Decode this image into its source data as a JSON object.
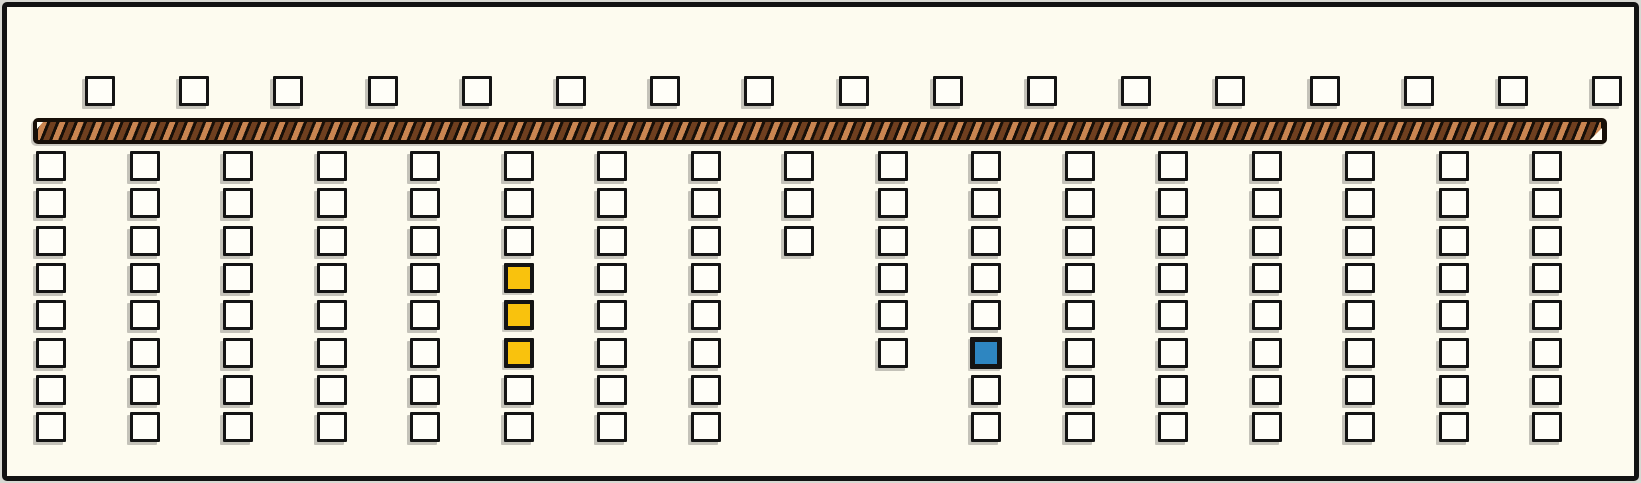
{
  "diagram": {
    "kind": "hatched-track-with-square-slots",
    "palette": {
      "background": "#fdfbef",
      "frame_border": "#121212",
      "square_fill": "#fffef8",
      "square_border": "#141414",
      "highlight_yellow": "#f9c20d",
      "highlight_blue": "#2e86c1",
      "track_base": "#170f08",
      "track_stripe_light": "#c98551",
      "track_stripe_dark": "#6f3f1f",
      "track_end_cap": "#fffdf2"
    },
    "top_row": {
      "count": 17
    },
    "track": {
      "pattern": "diagonal-hatch",
      "has_right_end_cap": true
    },
    "grid": {
      "row_count": 8,
      "column_count": 17,
      "columns": [
        {
          "index": 1,
          "squares": 8,
          "highlights": {}
        },
        {
          "index": 2,
          "squares": 8,
          "highlights": {}
        },
        {
          "index": 3,
          "squares": 8,
          "highlights": {}
        },
        {
          "index": 4,
          "squares": 8,
          "highlights": {}
        },
        {
          "index": 5,
          "squares": 8,
          "highlights": {}
        },
        {
          "index": 6,
          "squares": 8,
          "highlights": {
            "4": "yellow",
            "5": "yellow",
            "6": "yellow"
          }
        },
        {
          "index": 7,
          "squares": 8,
          "highlights": {}
        },
        {
          "index": 8,
          "squares": 8,
          "highlights": {}
        },
        {
          "index": 9,
          "squares": 3,
          "highlights": {}
        },
        {
          "index": 10,
          "squares": 6,
          "highlights": {}
        },
        {
          "index": 11,
          "squares": 8,
          "highlights": {
            "6": "blue"
          }
        },
        {
          "index": 12,
          "squares": 8,
          "highlights": {}
        },
        {
          "index": 13,
          "squares": 8,
          "highlights": {}
        },
        {
          "index": 14,
          "squares": 8,
          "highlights": {}
        },
        {
          "index": 15,
          "squares": 8,
          "highlights": {}
        },
        {
          "index": 16,
          "squares": 8,
          "highlights": {}
        },
        {
          "index": 17,
          "squares": 8,
          "highlights": {}
        }
      ]
    }
  }
}
